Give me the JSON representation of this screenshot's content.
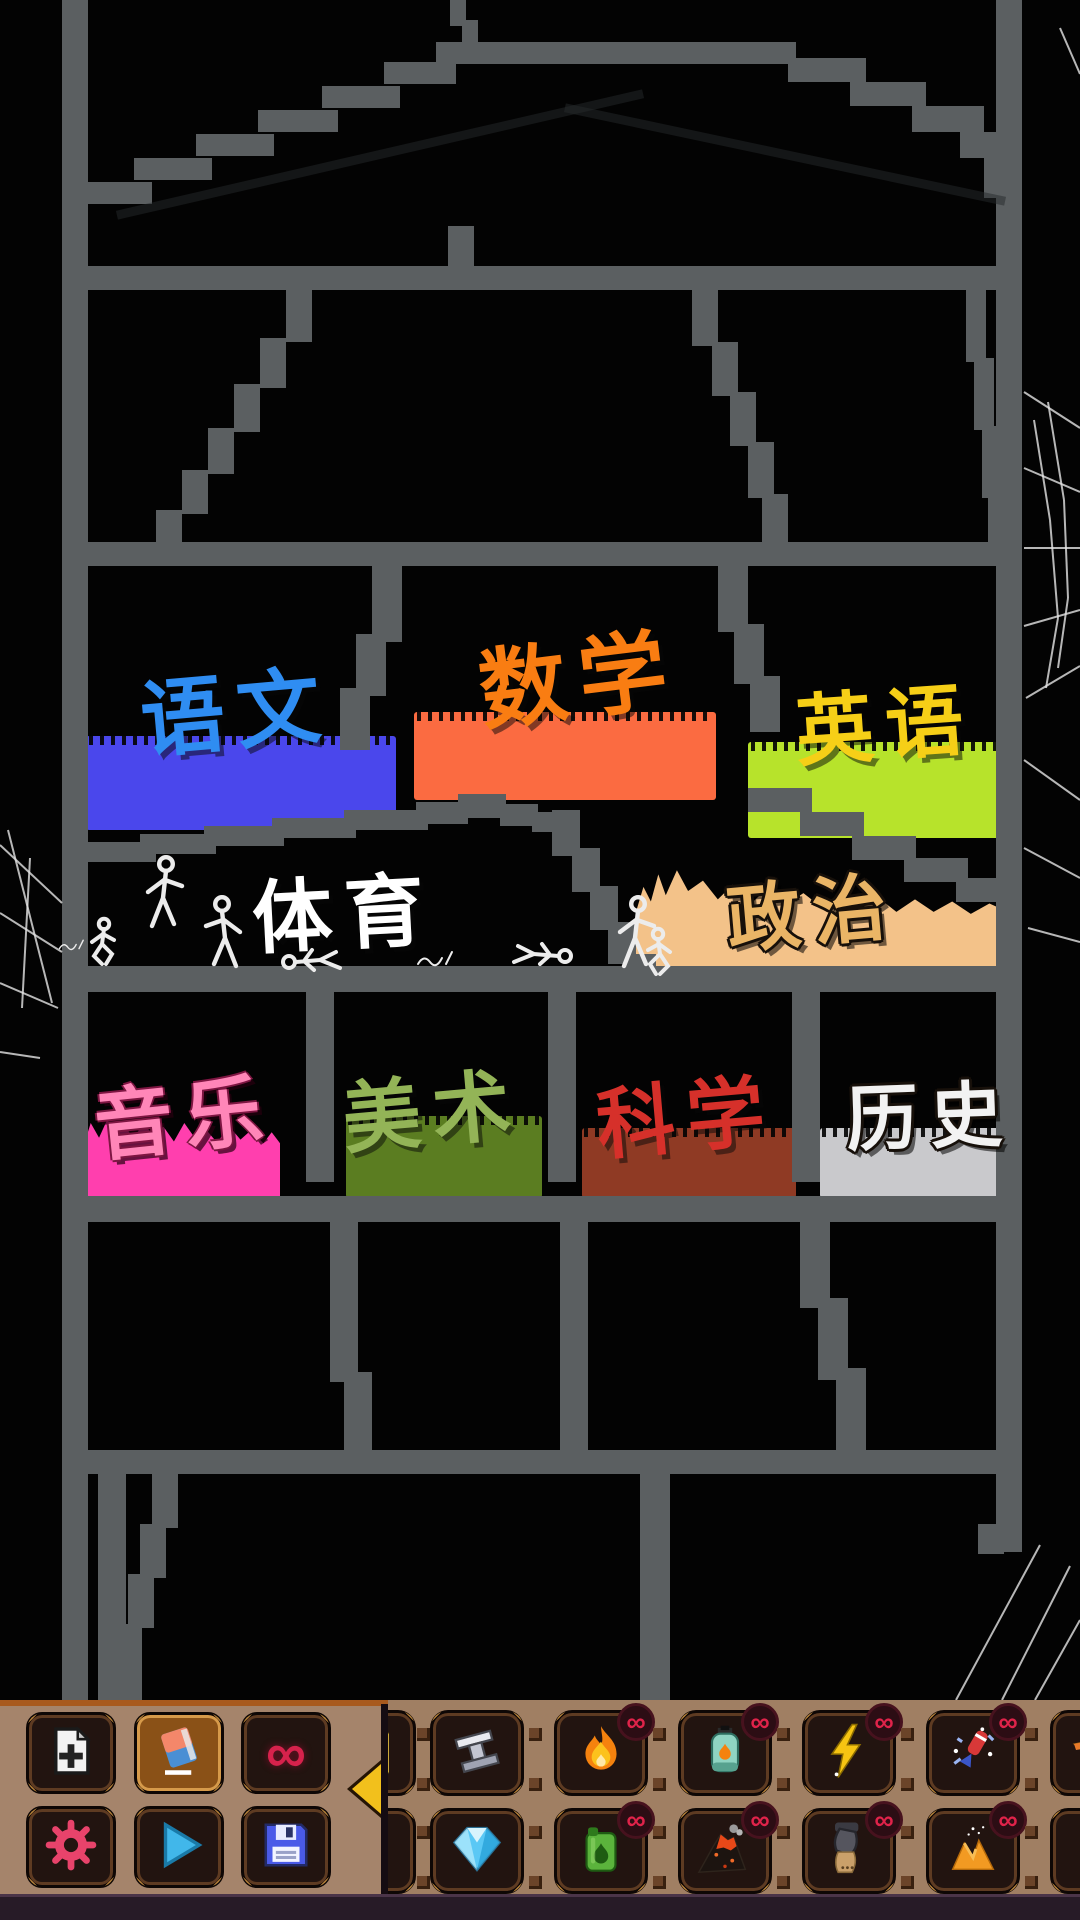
{
  "game": {
    "background_color": "#030303",
    "wall_color": "#5b5f61",
    "cobweb_color": "#e4e4e4",
    "scene_description": "pixel sandbox school building"
  },
  "rooms": {
    "chinese": {
      "label": "语文",
      "label_color": "#2f8df2",
      "platform_color": "#4a47ec"
    },
    "math": {
      "label": "数学",
      "label_color": "#f97d12",
      "platform_color": "#fb6b41"
    },
    "english": {
      "label": "英语",
      "label_color": "#f6cf17",
      "platform_color": "#b7e32b"
    },
    "pe": {
      "label": "体育",
      "label_color": "#ffffff",
      "platform_color": null
    },
    "politics": {
      "label": "政治",
      "label_color": "#eab566",
      "platform_color": "#f3c289"
    },
    "music": {
      "label": "音乐",
      "label_color": "#ff86b8",
      "platform_color": "#ff3fae"
    },
    "art": {
      "label": "美术",
      "label_color": "#93b457",
      "platform_color": "#5b7d21"
    },
    "science": {
      "label": "科学",
      "label_color": "#d6302a",
      "platform_color": "#8f3a24"
    },
    "history": {
      "label": "历史",
      "label_color": "#f2f2f2",
      "platform_color": "#c9c9cc"
    }
  },
  "toolbar": {
    "background_color": "#a5846b",
    "top_border_color": "#a85a1e",
    "infinity_glyph": "∞",
    "badge_glyph": "∞",
    "badge_color": "#e0234a",
    "collapse_arrow_direction": "left",
    "tools": {
      "new_file": {
        "name": "new-file"
      },
      "eraser_book": {
        "name": "eraser-book",
        "selected": true
      },
      "infinity": {
        "name": "infinity-mode"
      },
      "settings": {
        "name": "settings-gear"
      },
      "play": {
        "name": "play"
      },
      "save": {
        "name": "save"
      }
    },
    "palette": {
      "row1": [
        "steel-beam",
        "fire",
        "gas-canister",
        "lightning",
        "firework"
      ],
      "row2": [
        "diamond",
        "fuel-can",
        "volcano",
        "cannon",
        "sand-pile"
      ],
      "row1_has_badge": [
        false,
        true,
        true,
        true,
        true
      ],
      "row2_has_badge": [
        false,
        true,
        true,
        true,
        true
      ],
      "partially_visible": [
        "drink-can",
        "dynamite",
        "pizza-slice",
        "zombie-hand"
      ]
    }
  }
}
